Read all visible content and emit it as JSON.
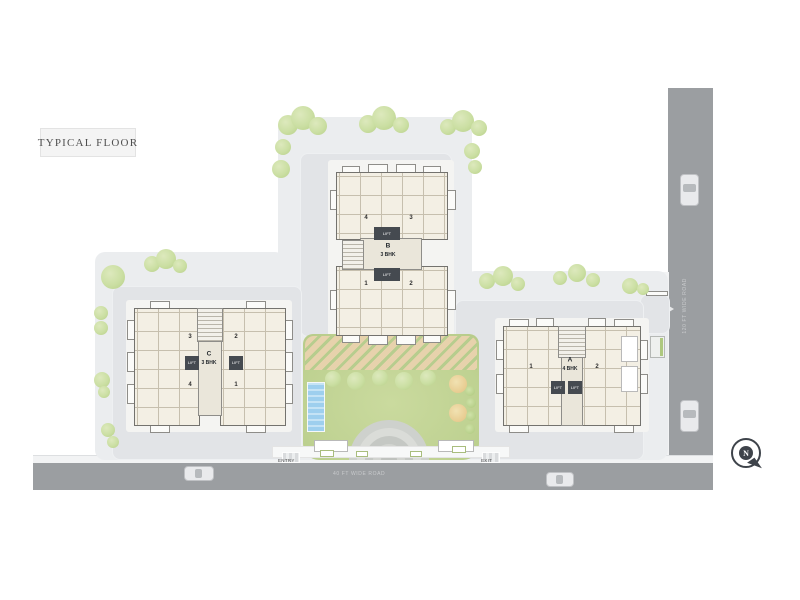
{
  "title": "TYPICAL FLOOR",
  "lift_label": "LIFT",
  "site": {
    "roads": {
      "right_label": "120 FT WIDE ROAD",
      "bottom_label": "40 FT WIDE ROAD"
    },
    "entry_label": "ENTRY",
    "exit_label": "EXIT",
    "compass_label": "N"
  },
  "buildings": {
    "a": {
      "name": "A",
      "type": "4 BHK",
      "units": [
        "1",
        "2"
      ]
    },
    "b": {
      "name": "B",
      "type": "3 BHK",
      "units_top": [
        "4",
        "3"
      ],
      "units_bottom": [
        "1",
        "2"
      ]
    },
    "c": {
      "name": "C",
      "type": "3 BHK",
      "units_top": [
        "3",
        "2"
      ],
      "units_bottom": [
        "4",
        "1"
      ]
    }
  },
  "colors": {
    "road": "#9b9ea1",
    "site_plate": "#ebedef",
    "paving": "#e2e4e7",
    "garden_green": "#c1d494",
    "tree_green": "#cbdfa3",
    "building_cream": "#f3efe4",
    "lift_dark": "#454a50",
    "water_blue": "#9ecfee",
    "pergola_tan": "#e7d2ac",
    "compass_dark": "#3e434a"
  }
}
